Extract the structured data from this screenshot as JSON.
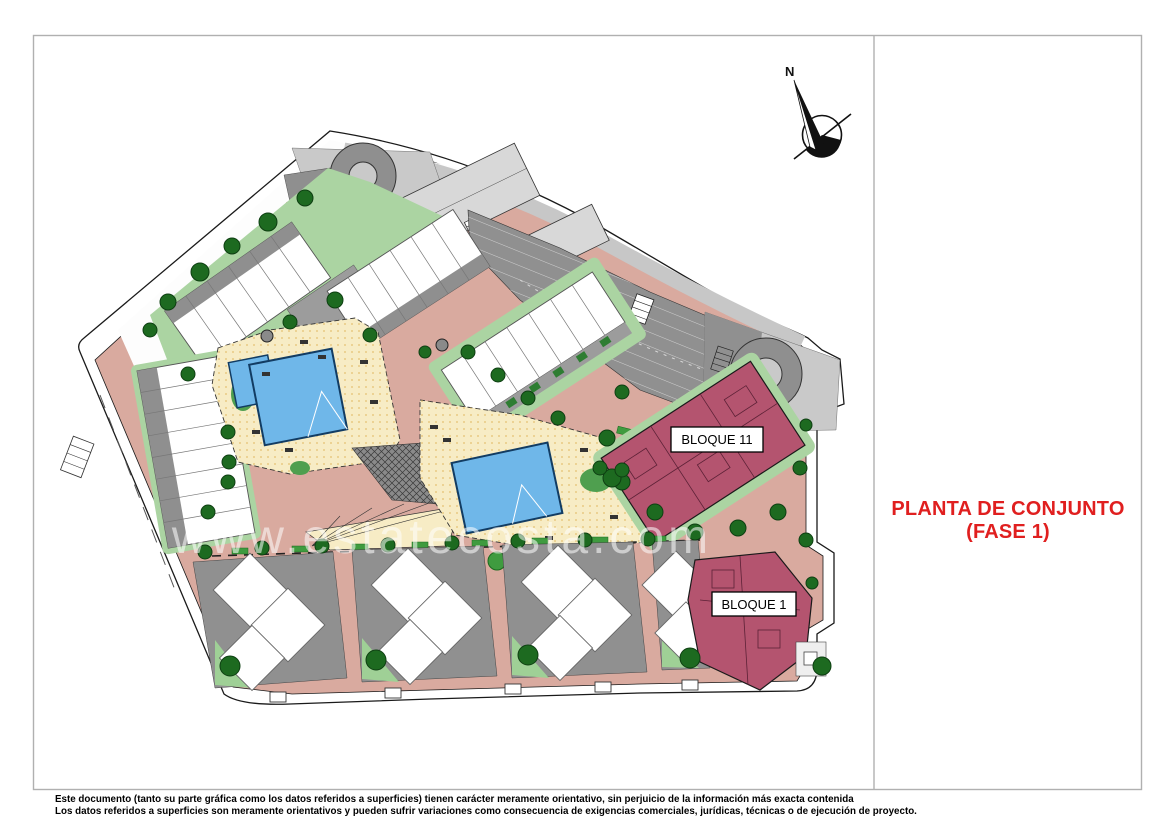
{
  "title": {
    "line1": "PLANTA DE CONJUNTO",
    "line2": "(FASE 1)"
  },
  "compass": {
    "label": "N"
  },
  "watermark": "www.estatecosta.com",
  "labels": {
    "bloque11": "BLOQUE 11",
    "bloque1": "BLOQUE 1"
  },
  "footer": {
    "line1": "Este documento (tanto su parte gráfica como los datos referidos a superficies) tienen carácter meramente orientativo, sin perjuicio de la información más exacta contenida",
    "line2": "Los datos referidos a superficies son meramente orientativos y pueden sufrir variaciones como consecuencia de exigencias comerciales, jurídicas, técnicas o de ejecución de proyecto."
  },
  "colors": {
    "title_red": "#E01F1F",
    "path_salmon": "#D9AA9F",
    "lawn_green": "#ABD4A2",
    "tree_green": "#1D6A20",
    "pool_blue": "#6FB7E9",
    "deck_cream": "#F7ECC5",
    "parking_gray": "#909090",
    "road_gray": "#C7C7C7",
    "block_pink": "#B4546F"
  }
}
